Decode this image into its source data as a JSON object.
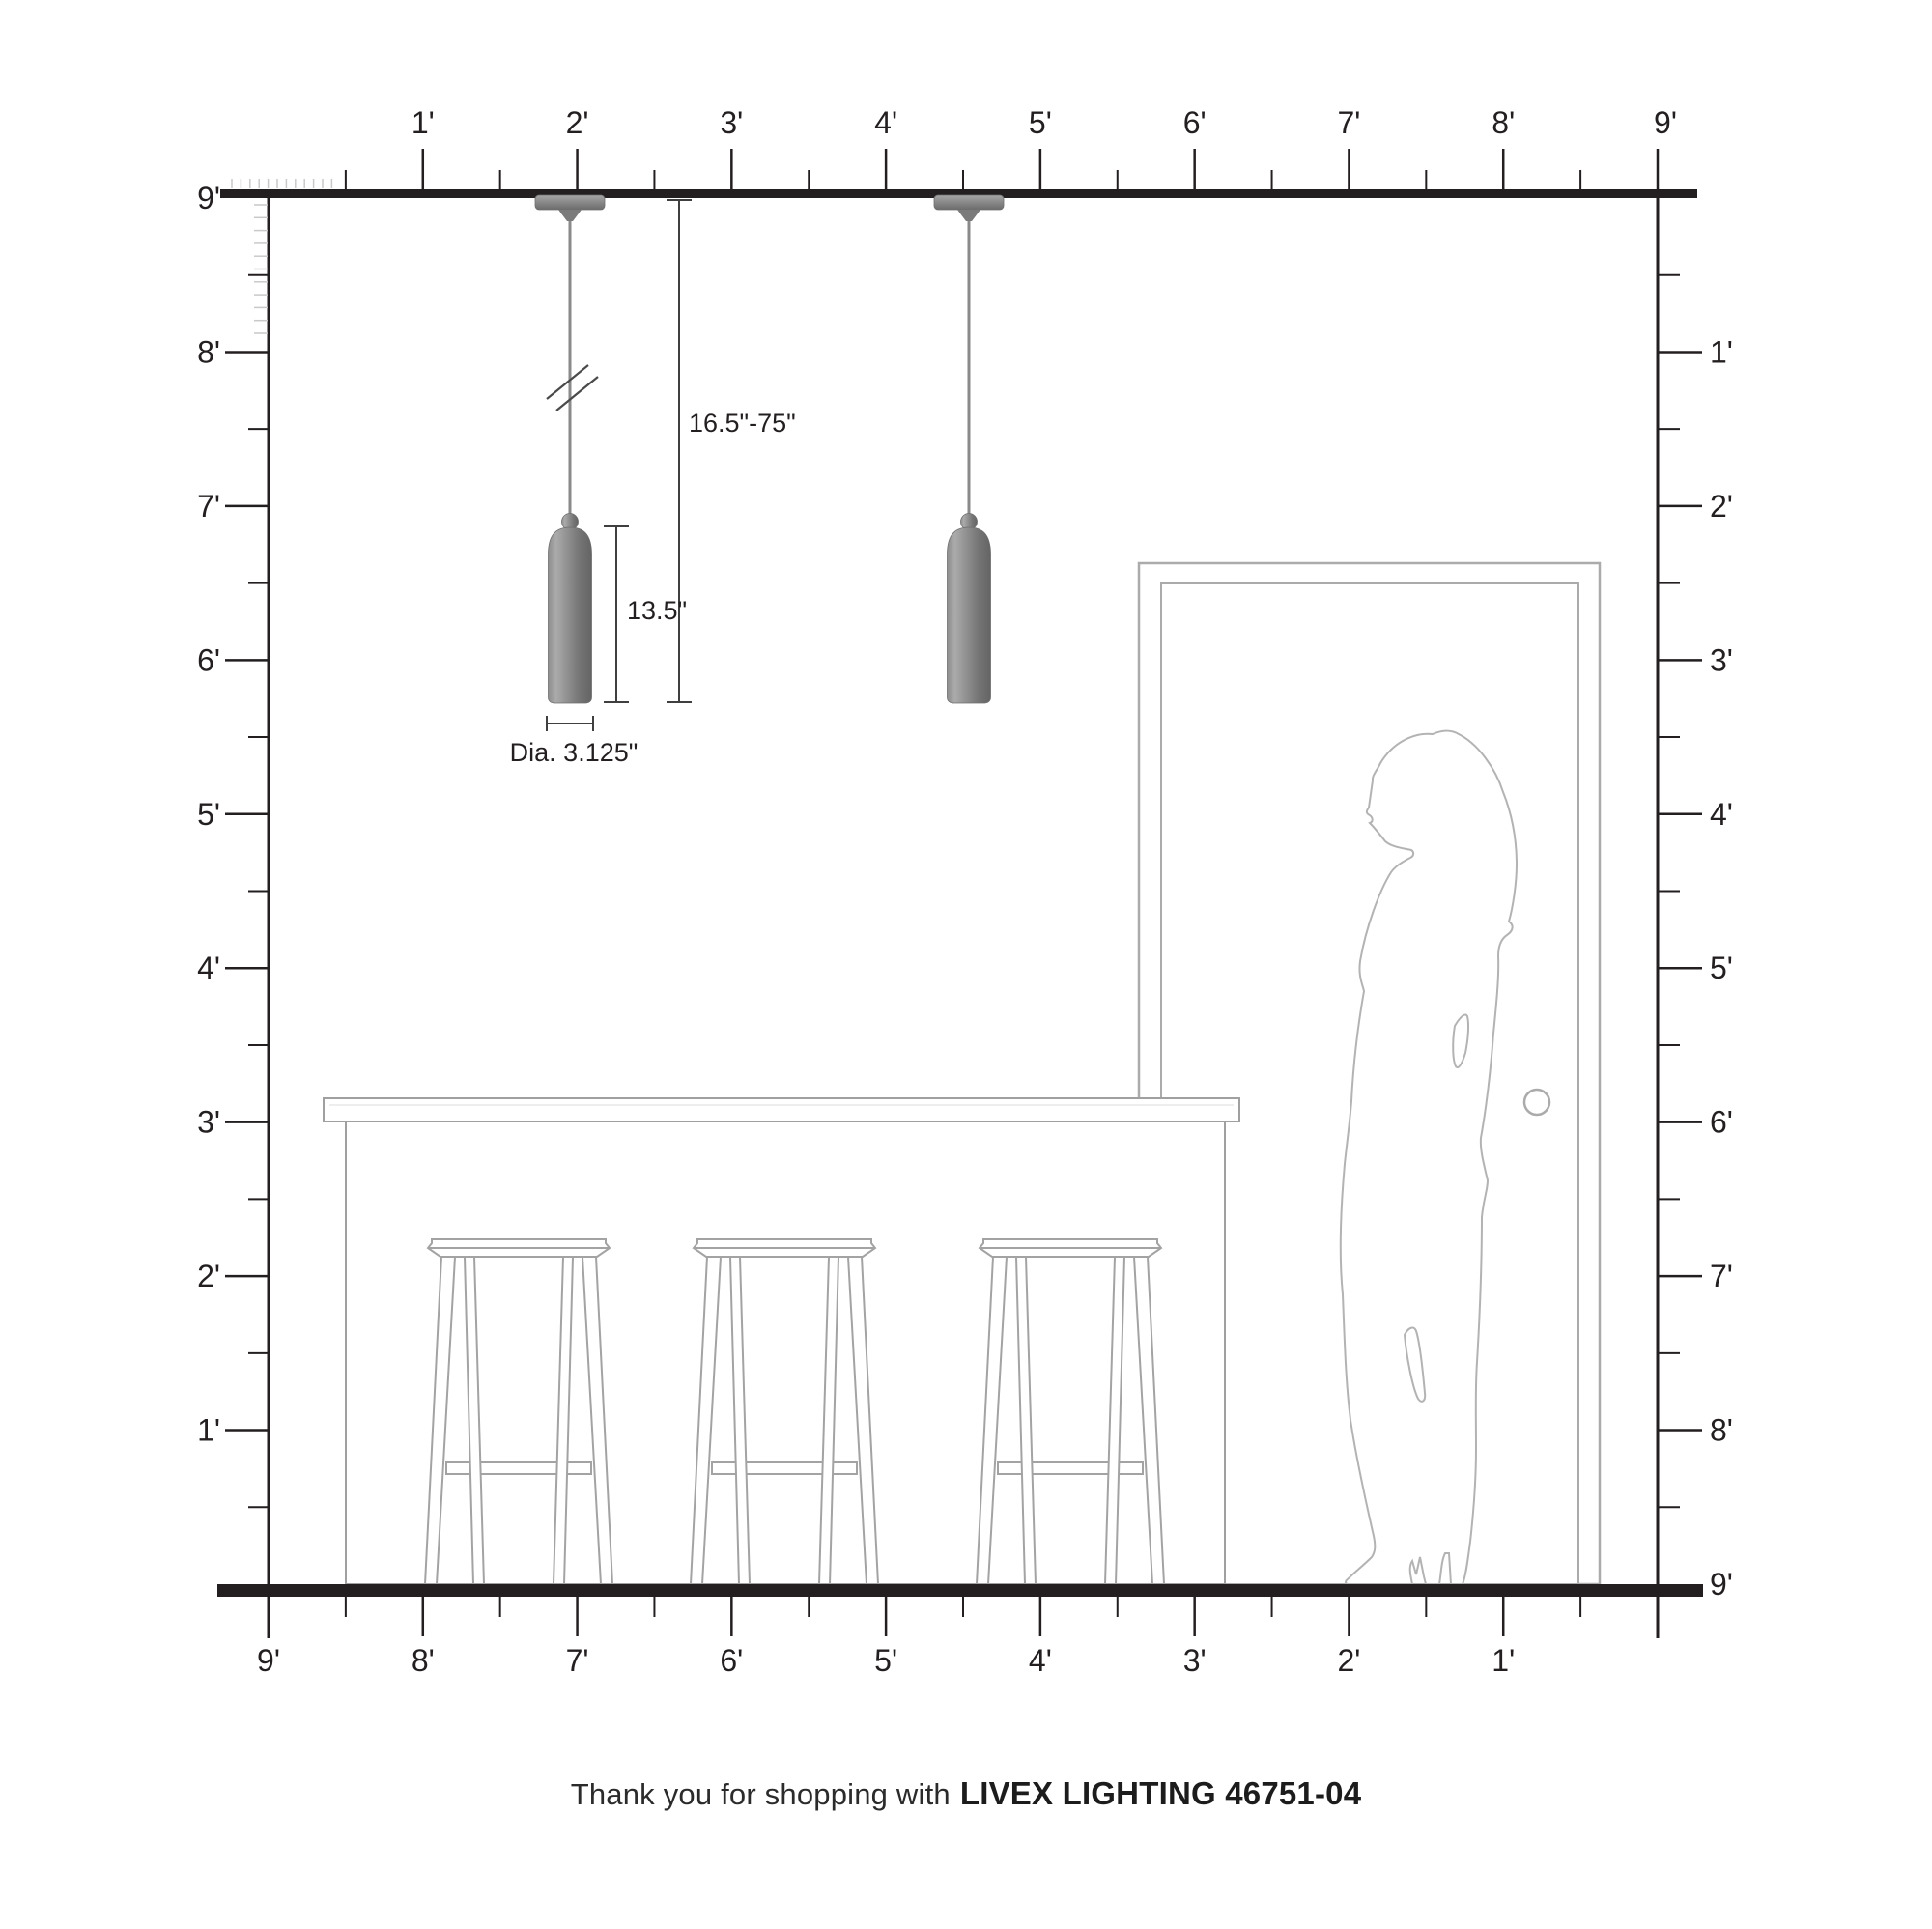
{
  "footer": {
    "thanks_prefix": "Thank you for shopping with",
    "brand_line": "LIVEX LIGHTING 46751-04"
  },
  "dimensions": {
    "suspension_range": "16.5\"-75\"",
    "fixture_height": "13.5\"",
    "fixture_diameter": "Dia. 3.125\""
  },
  "rulers": {
    "top": {
      "labels": [
        "1'",
        "2'",
        "3'",
        "4'",
        "5'",
        "6'",
        "7'",
        "8'",
        "9'"
      ]
    },
    "left": {
      "labels": [
        "9'",
        "8'",
        "7'",
        "6'",
        "5'",
        "4'",
        "3'",
        "2'",
        "1'"
      ]
    },
    "right": {
      "labels": [
        "1'",
        "2'",
        "3'",
        "4'",
        "5'",
        "6'",
        "7'",
        "8'",
        "9'"
      ]
    },
    "bottom": {
      "labels": [
        "9'",
        "8'",
        "7'",
        "6'",
        "5'",
        "4'",
        "3'",
        "2'",
        "1'"
      ]
    }
  },
  "colors": {
    "ruler_ink": "#231f20",
    "inch_tick": "#c9c9c9",
    "outline_gray": "#adadad",
    "dimension_ink": "#3f3f3f",
    "pendant_light": "#ababab",
    "pendant_mid": "#8f8f8f",
    "pendant_dark": "#646464",
    "cord_gray": "#8a8a8a"
  }
}
